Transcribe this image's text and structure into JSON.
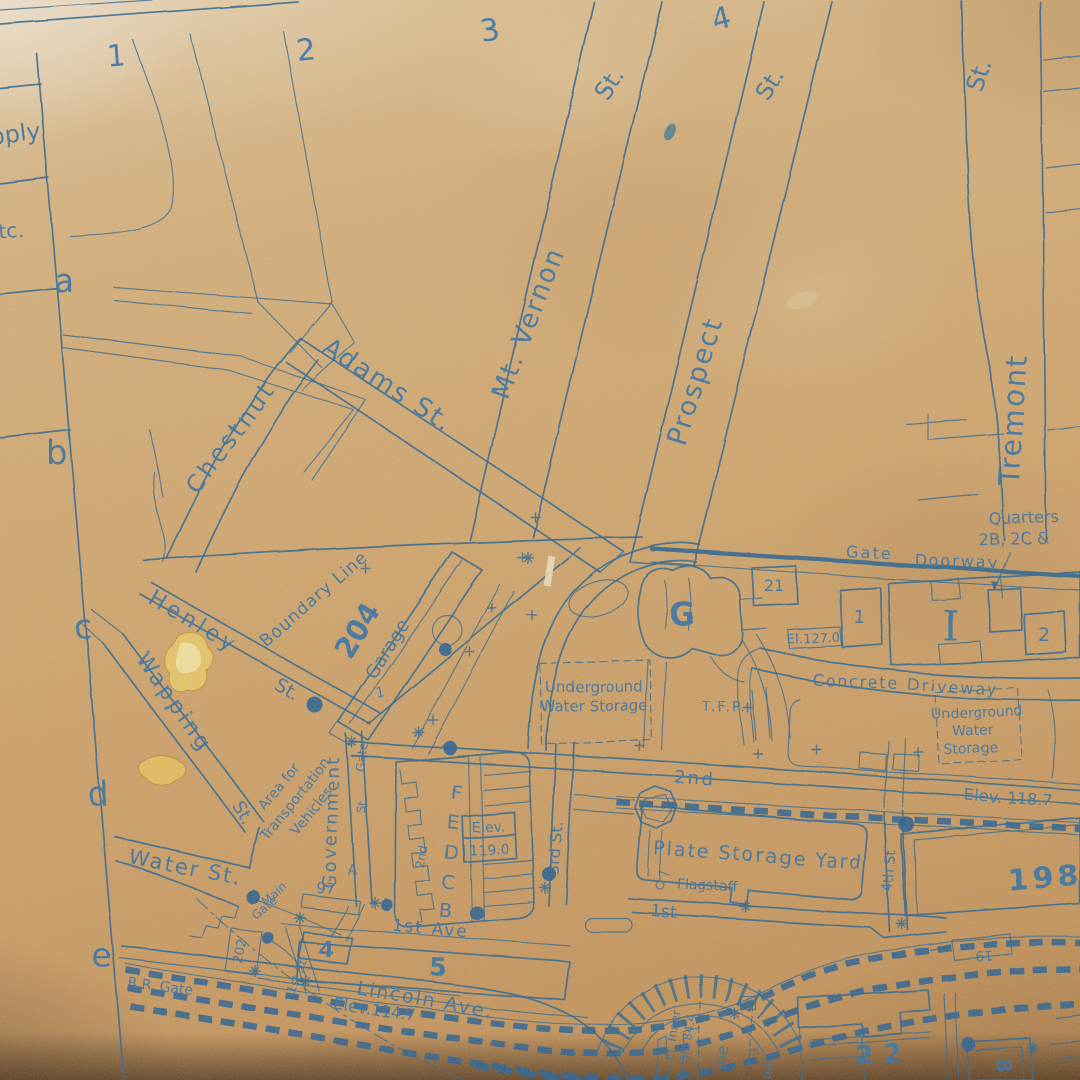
{
  "map": {
    "colors": {
      "ink": "#23608f",
      "ink_dark": "#1d5a92",
      "paper": "#cfa46c",
      "damage_gold": "#e8c868"
    },
    "grid": {
      "cols": [
        "1",
        "2",
        "3",
        "4"
      ],
      "rows": [
        "a",
        "b",
        "c",
        "d",
        "e"
      ]
    },
    "margin": {
      "supply_partial": "pply",
      "etc_partial": "tc."
    },
    "labels": {
      "chestnut": "Chestnut",
      "adams": "Adams St.",
      "mt_vernon": "Mt. Vernon",
      "mt_vernon_st": "St.",
      "prospect": "Prospect",
      "prospect_st": "St.",
      "tremont": "Tremont",
      "tremont_st": "St.",
      "henley": "Henley",
      "henley_st": "St.",
      "wapping": "Wapping",
      "wapping_st": "St.",
      "water_st": "Water St.",
      "boundary_line": "Boundary Line",
      "garage_num": "204",
      "garage": "Garage",
      "garage_one": "1",
      "area_1": "Area for",
      "area_2": "Transportation",
      "area_3": "Vehicles",
      "government": "Government",
      "gate_v": "Gate",
      "st_v": "St.",
      "second_v": "2nd",
      "a_small": "A",
      "bldg_f": "F",
      "bldg_e": "E",
      "bldg_d": "D",
      "bldg_c": "C",
      "bldg_b": "B",
      "elev_word": "Elev.",
      "elev_119": "119.0",
      "third_st": "3rd St.",
      "g_building": "G",
      "n21": "21",
      "quarters_1": "Quarters",
      "quarters_2": "2B, 2C &",
      "gate": "Gate",
      "doorway": "Doorway",
      "bldg_1": "1",
      "bldg_i": "I",
      "bldg_2": "2",
      "el_127": "El.127.0",
      "concrete_driveway": "Concrete Driveway",
      "uws_left_1": "Underground",
      "uws_left_2": "Water Storage",
      "uws_right_1": "Underground",
      "uws_right_2": "Water",
      "uws_right_3": "Storage",
      "tfp": "T.F.P.",
      "second_st": "2nd",
      "elev_1187": "Elev. 118.7",
      "plate_yard": "Plate Storage Yard",
      "flagstaff": "Flagstaff",
      "first_st_h": "1st",
      "fourth_st": "4th St",
      "n198": "198",
      "n19": "19",
      "n22": "22",
      "n8": "8",
      "el_inner": "El. Inner",
      "sill_844": "Sill 84.4",
      "line_partial": "ine",
      "fuel_partial": "uel",
      "e_mark": "E",
      "first_ave": "1st Ave",
      "n5": "5",
      "lincoln": "Lincoln Ave.",
      "elev_1147": "Elev.114.7",
      "rr_gate": "R.R. Gate",
      "main": "Main",
      "gate_main": "Gate",
      "n97": "97",
      "n202": "202",
      "n4": "4",
      "first_st_d": "1st St."
    }
  }
}
